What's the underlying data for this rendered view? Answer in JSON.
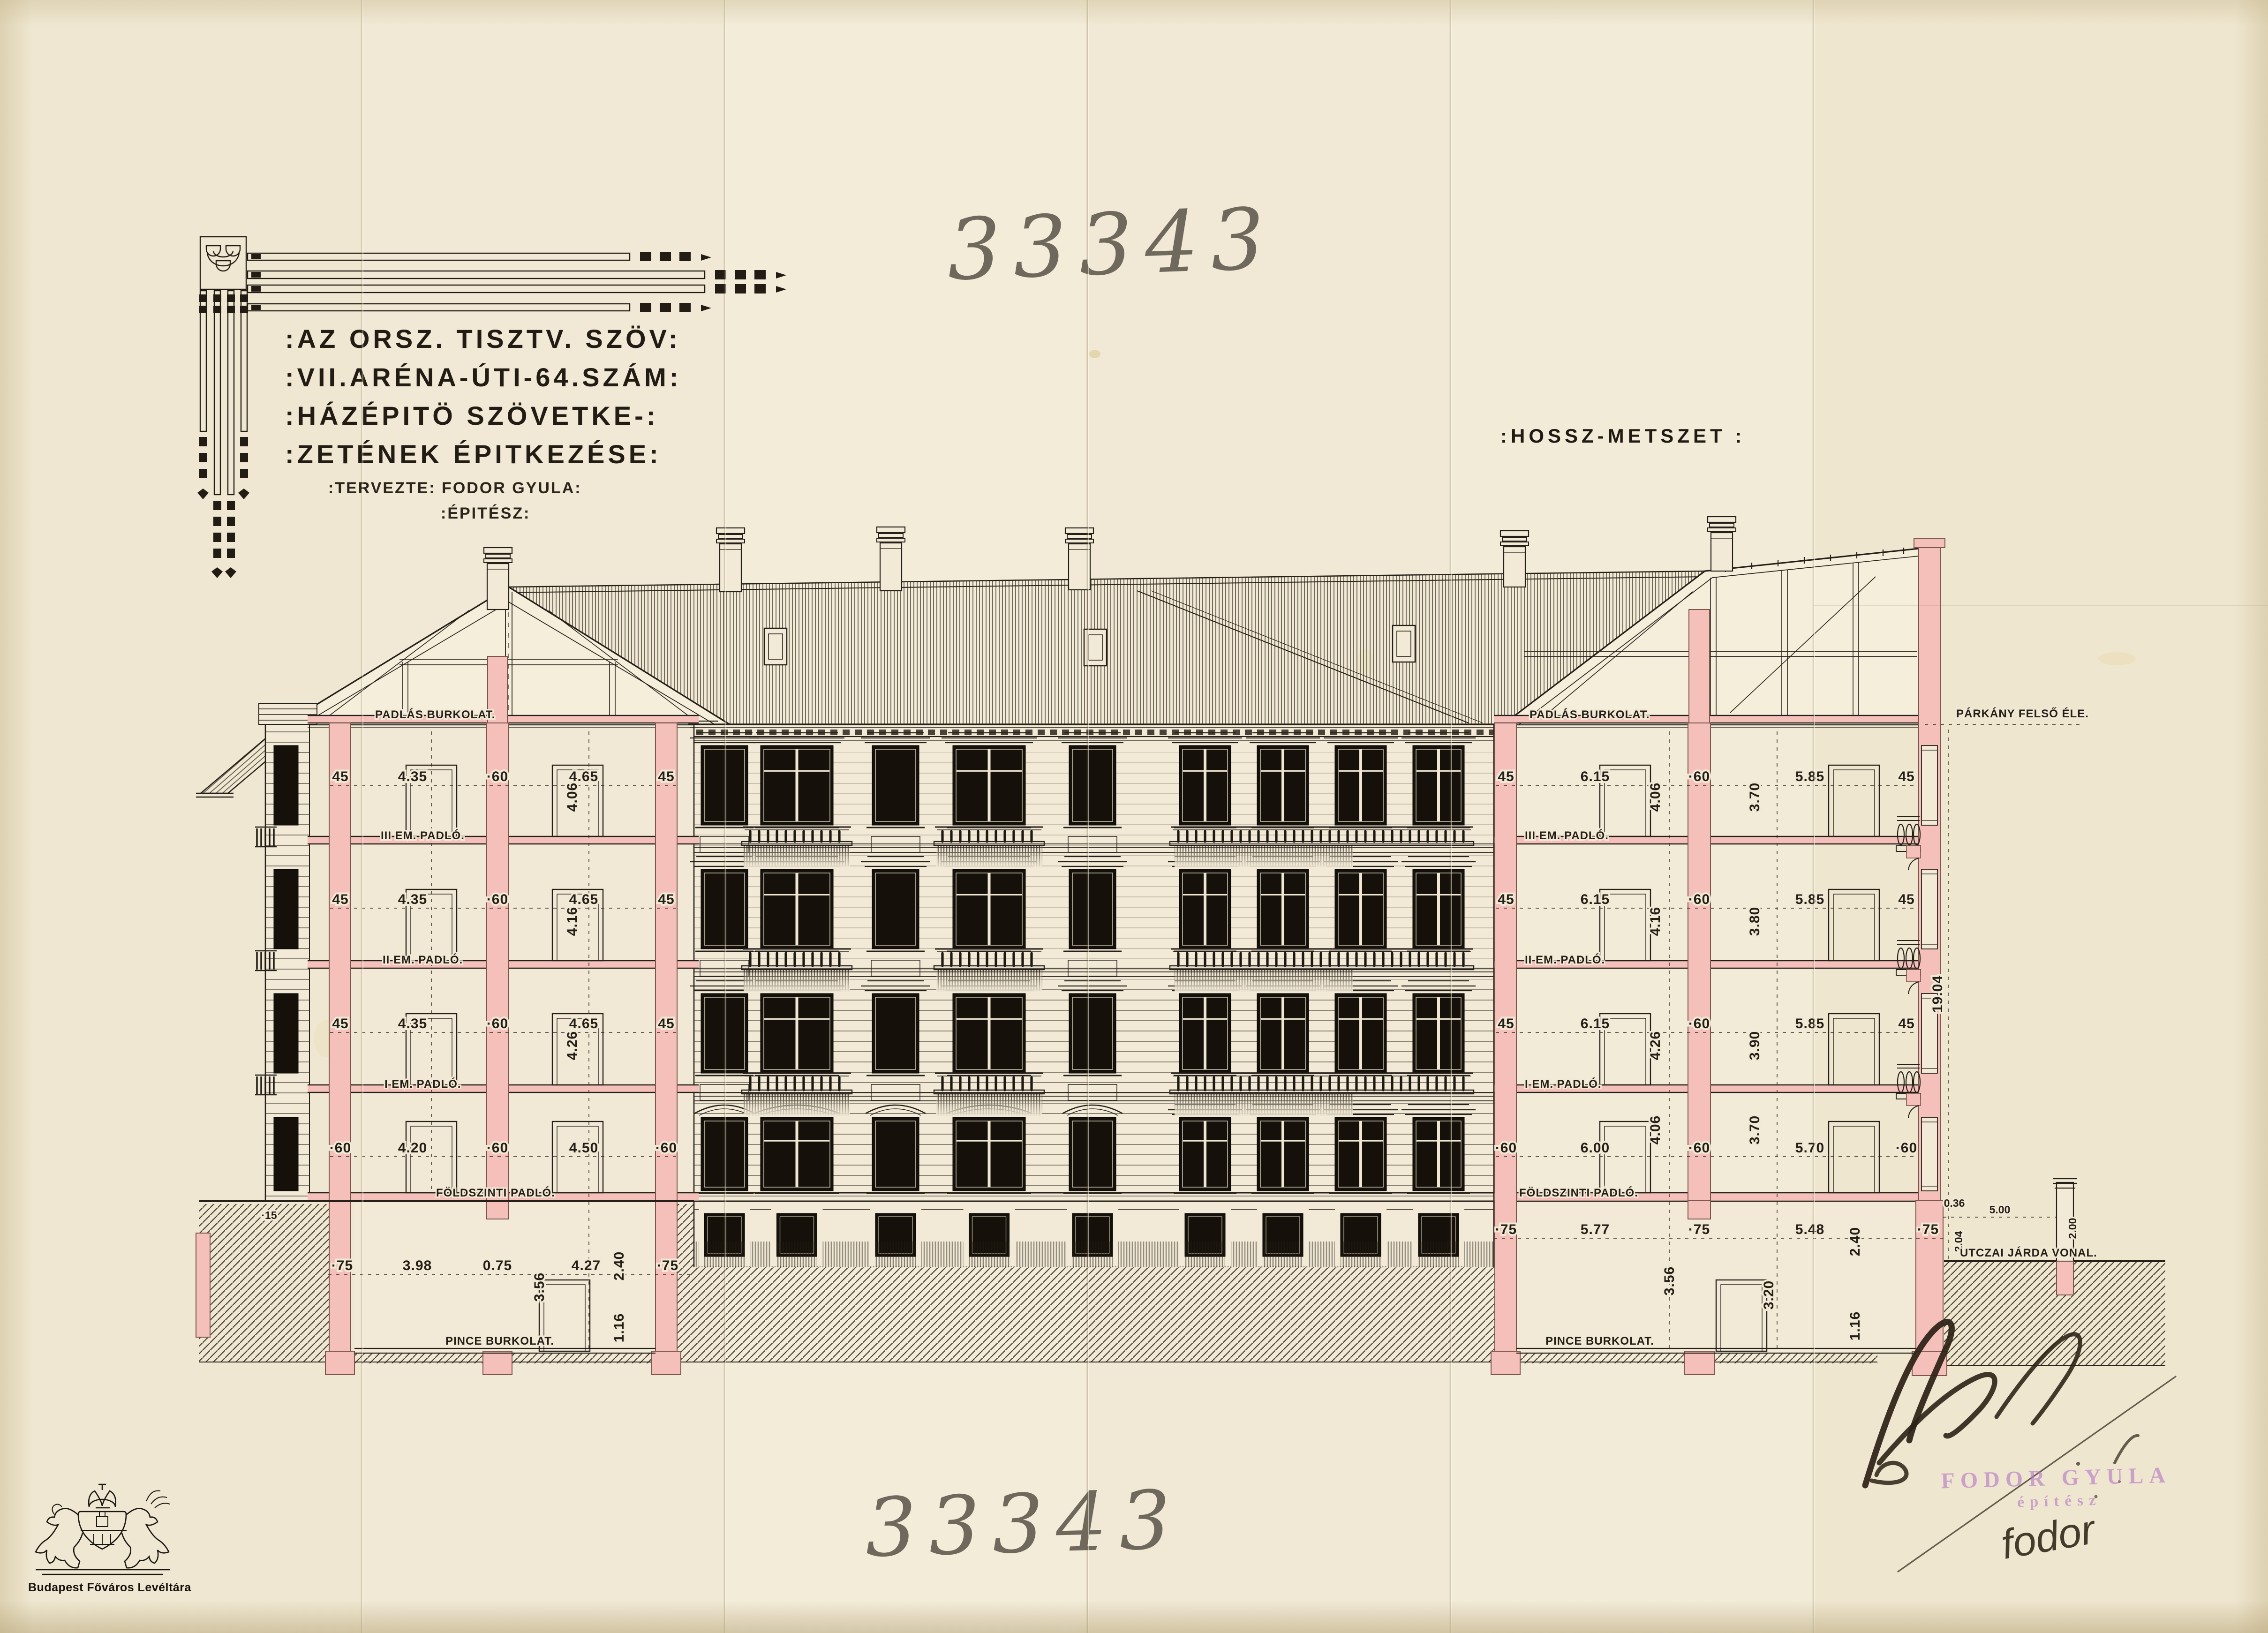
{
  "page": {
    "archive_number": "33343"
  },
  "title_block": {
    "line1": ":AZ ORSZ. TISZTV. SZÖV:",
    "line2": ":VII.ARÉNA-ÚTI-64.SZÁM:",
    "line3": ":HÁZÉPITÖ SZÖVETKE-:",
    "line4": ":ZETÉNEK ÉPITKEZÉSE:",
    "designer": ":TERVEZTE: FODOR GYULA:",
    "role": ":ÉPITÉSZ:"
  },
  "drawing": {
    "label": ":HOSSZ-METSZET :",
    "floor_labels": {
      "attic": "PADLÁS BURKOLAT.",
      "f3": "III EM. PADLÓ.",
      "f2": "II EM. PADLÓ.",
      "f1": "I EM. PADLÓ.",
      "ground": "FÖLDSZINTI PADLÓ.",
      "cellar": "PINCE BURKOLAT."
    },
    "annotations": {
      "cornice": "PÁRKÁNY FELSŐ ÉLE.",
      "sidewalk": "UTCZAI JÁRDA VONAL.",
      "total_height": "19.04",
      "sidewalk_step": "0.36",
      "street_width": "5.00",
      "post_h1": "2.04",
      "post_h2": "2.00",
      "ground_mark": "·15"
    },
    "dims": {
      "left": {
        "s3": [
          "45",
          "4.35",
          "·60",
          "4.65",
          "45"
        ],
        "s2": [
          "45",
          "4.35",
          "·60",
          "4.65",
          "45"
        ],
        "s1": [
          "45",
          "4.35",
          "·60",
          "4.65",
          "45"
        ],
        "g": [
          "·60",
          "4.20",
          "·60",
          "4.50",
          "·60"
        ],
        "b": [
          "·75",
          "3.98",
          "0.75",
          "4.27",
          "·75"
        ],
        "v": [
          "4.06",
          "4.16",
          "4.26"
        ],
        "bv": [
          "3.56",
          "2.40",
          "1.16"
        ]
      },
      "right": {
        "s3": [
          "45",
          "6.15",
          "·60",
          "5.85",
          "45"
        ],
        "s2": [
          "45",
          "6.15",
          "·60",
          "5.85",
          "45"
        ],
        "s1": [
          "45",
          "6.15",
          "·60",
          "5.85",
          "45"
        ],
        "g": [
          "·60",
          "6.00",
          "·60",
          "5.70",
          "·60"
        ],
        "b": [
          "·75",
          "5.77",
          "·75",
          "5.48",
          "·75"
        ],
        "v3": [
          "4.06",
          "3.70"
        ],
        "v2": [
          "4.16",
          "3.80"
        ],
        "v1": [
          "4.26",
          "3.90"
        ],
        "vg": [
          "4.06",
          "3.70"
        ],
        "bv": [
          "3.56",
          "3.20",
          "2.40",
          "1.16"
        ]
      }
    }
  },
  "stamp": {
    "name": "FODOR GYULA",
    "role": "építész",
    "signature": "fodor"
  },
  "archive_logo": {
    "caption": "Budapest Főváros Levéltára"
  }
}
